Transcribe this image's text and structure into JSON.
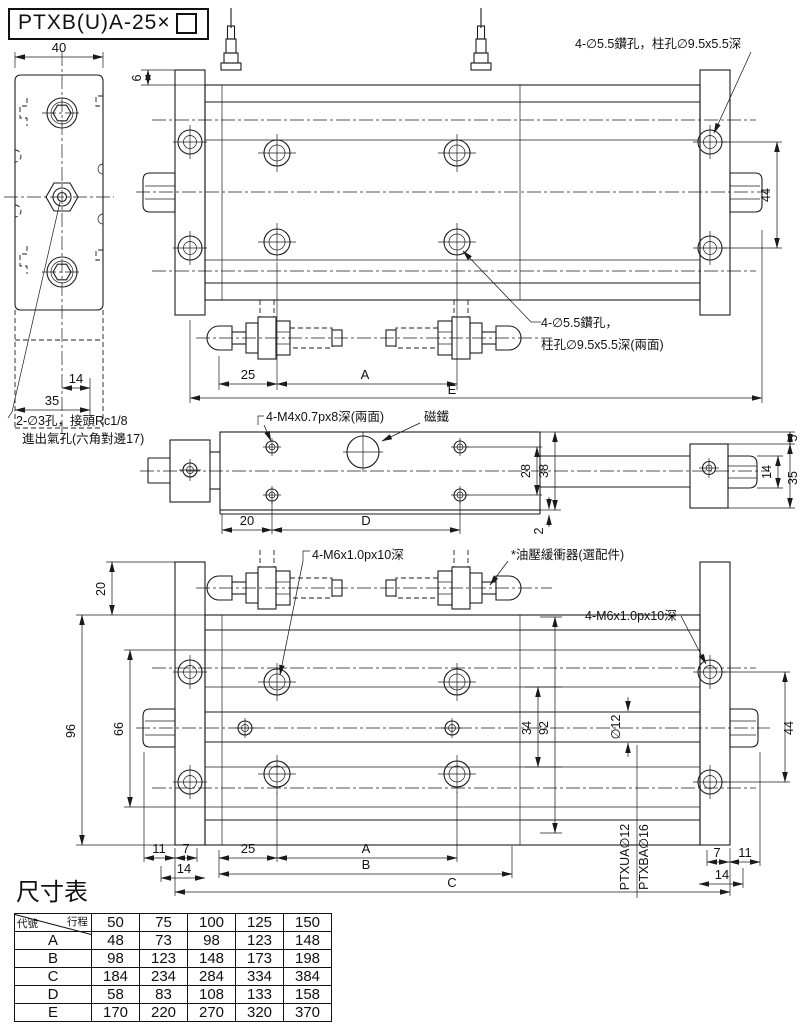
{
  "title": {
    "model": "PTXB(U)A-25×"
  },
  "annotations": {
    "drill_top": "4-∅5.5鑽孔，柱孔∅9.5x5.5深",
    "drill_mid_1": "4-∅5.5鑽孔，",
    "drill_mid_2": "柱孔∅9.5x5.5深(兩面)",
    "port_1": "2-∅3孔，接頭Rc1/8",
    "port_2": "進出氣孔(六角對邊17)",
    "m4_thread": "4-M4x0.7px8深(兩面)",
    "magnet": "磁鐵",
    "m6_bottom": "4-M6x1.0px10深",
    "damper": "*油壓緩衝器(選配件)",
    "m6_right": "4-M6x1.0px10深",
    "rod_label_a": "PTXUA∅12",
    "rod_label_b": "PTXBA∅16"
  },
  "dims": {
    "side": {
      "w40": "40",
      "d14": "14",
      "d35": "35"
    },
    "top": {
      "d6": "6",
      "d44": "44",
      "d25": "25",
      "dA": "A",
      "dE": "E"
    },
    "front": {
      "d20": "20",
      "dD": "D",
      "d28": "28",
      "d38": "38",
      "d2": "2",
      "d5": "5",
      "d14": "14",
      "d35": "35"
    },
    "bottom": {
      "d20": "20",
      "d96": "96",
      "d66": "66",
      "d11L": "11",
      "d7L": "7",
      "d14L": "14",
      "d25": "25",
      "dA": "A",
      "dB": "B",
      "dC": "C",
      "d34": "34",
      "d92": "92",
      "dia12": "∅12",
      "d44": "44",
      "d7R": "7",
      "d11R": "11",
      "d14R": "14"
    }
  },
  "table": {
    "title": "尺寸表",
    "corner_top": "行程",
    "corner_bottom": "代號",
    "columns": [
      "50",
      "75",
      "100",
      "125",
      "150"
    ],
    "rows": [
      {
        "label": "A",
        "values": [
          "48",
          "73",
          "98",
          "123",
          "148"
        ]
      },
      {
        "label": "B",
        "values": [
          "98",
          "123",
          "148",
          "173",
          "198"
        ]
      },
      {
        "label": "C",
        "values": [
          "184",
          "234",
          "284",
          "334",
          "384"
        ]
      },
      {
        "label": "D",
        "values": [
          "58",
          "83",
          "108",
          "133",
          "158"
        ]
      },
      {
        "label": "E",
        "values": [
          "170",
          "220",
          "270",
          "320",
          "370"
        ]
      }
    ]
  }
}
